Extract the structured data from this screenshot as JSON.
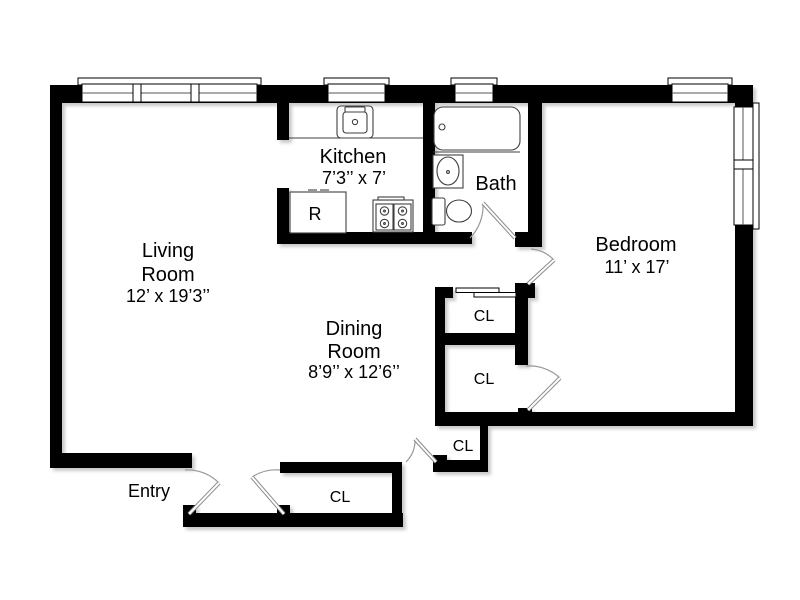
{
  "floorplan": {
    "labels": {
      "living_room": {
        "line1": "Living",
        "line2": "Room",
        "dims": "12’ x 19’3’’"
      },
      "dining_room": {
        "line1": "Dining",
        "line2": "Room",
        "dims": "8’9’’ x 12’6’’"
      },
      "kitchen": {
        "line1": "Kitchen",
        "dims": "7’3’’ x 7’"
      },
      "bath": {
        "line1": "Bath"
      },
      "bedroom": {
        "line1": "Bedroom",
        "dims": "11’ x 17’"
      },
      "entry": {
        "line1": "Entry"
      },
      "closet_abbr": "CL",
      "refrigerator_abbr": "R"
    },
    "colors": {
      "wall": "#000000",
      "background": "#ffffff",
      "fixture_outline": "#3f3f3f",
      "door_line": "#999999"
    }
  }
}
